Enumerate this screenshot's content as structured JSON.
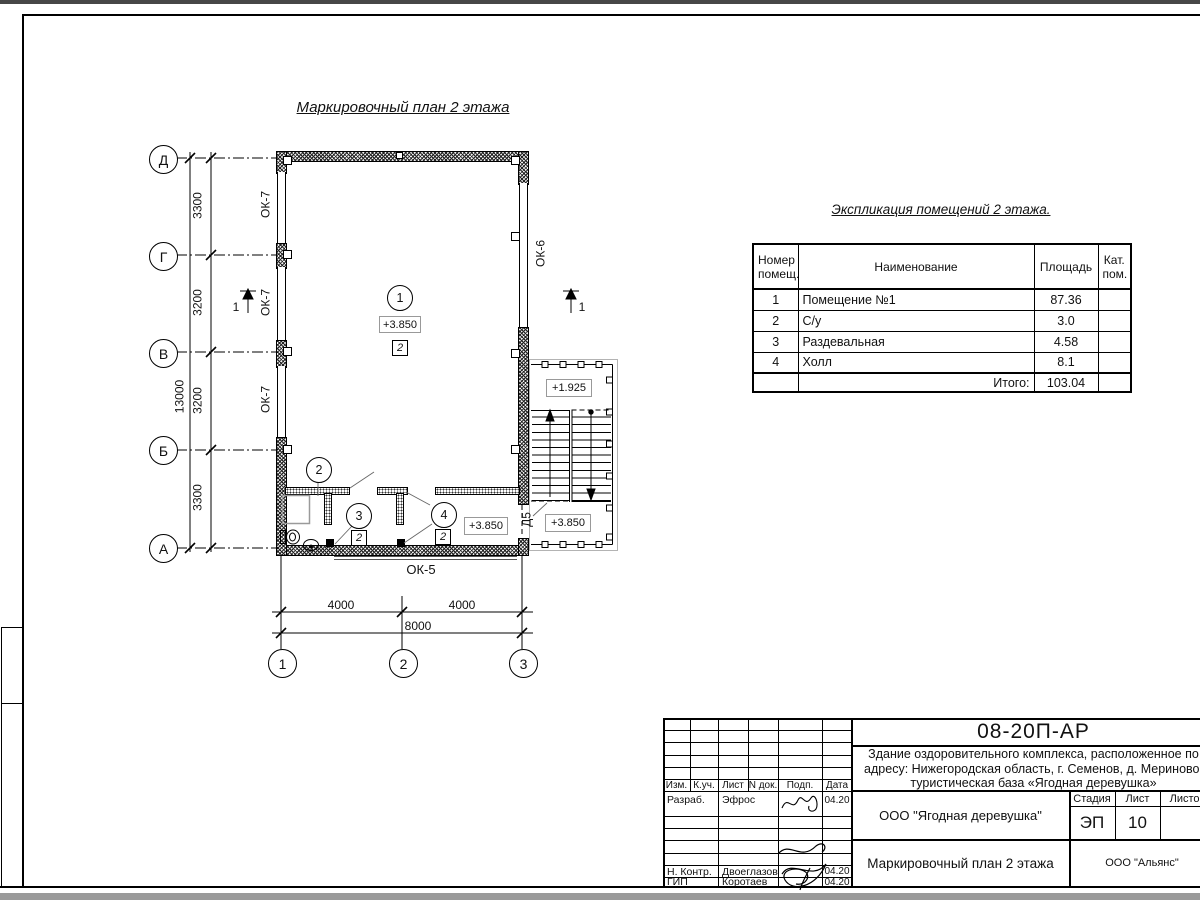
{
  "plan": {
    "title": "Маркировочный план 2 этажа",
    "axesH": [
      "Д",
      "Г",
      "В",
      "Б",
      "А"
    ],
    "axesV": [
      "1",
      "2",
      "3"
    ],
    "dimsLeft": [
      "3300",
      "3200",
      "3200",
      "3300"
    ],
    "dimLeftTotal": "13000",
    "dimsBottom": [
      "4000",
      "4000"
    ],
    "dimBottomTotal": "8000",
    "ok7": [
      "ОК-7",
      "ОК-7",
      "ОК-7"
    ],
    "ok6": "ОК-6",
    "ok5": "ОК-5",
    "d5": "Д5",
    "section": "1",
    "rooms": [
      "1",
      "2",
      "3",
      "4"
    ],
    "cat": "2",
    "elevMain": "+3.850",
    "elevHall": "+3.850",
    "elevStairMid": "+1.925",
    "elevStairBottom": "+3.850"
  },
  "table": {
    "title": "Экспликация помещений 2 этажа.",
    "colNum": "Номер помещ.",
    "colName": "Наименование",
    "colArea": "Площадь",
    "colCat": "Кат. пом.",
    "rows": [
      {
        "num": "1",
        "name": "Помещение №1",
        "area": "87.36",
        "cat": ""
      },
      {
        "num": "2",
        "name": "С/у",
        "area": "3.0",
        "cat": ""
      },
      {
        "num": "3",
        "name": "Раздевальная",
        "area": "4.58",
        "cat": ""
      },
      {
        "num": "4",
        "name": "Холл",
        "area": "8.1",
        "cat": ""
      }
    ],
    "totalLabel": "Итого:",
    "totalValue": "103.04"
  },
  "titleblock": {
    "code": "08-20П-АР",
    "objectLine1": "Здание оздоровительного комплекса, расположенное по",
    "objectLine2": "адресу: Нижегородская область, г. Семенов, д. Мериново,",
    "objectLine3": "туристическая база «Ягодная деревушка»",
    "cols": [
      "Изм.",
      "К.уч.",
      "Лист",
      "N док.",
      "Подп.",
      "Дата"
    ],
    "rowDevLabel": "Разраб.",
    "rowDevName": "Эфрос",
    "rowDevDate": "04.20",
    "rowNcLabel": "Н. Контр.",
    "rowNcName": "Двоеглазов",
    "rowNcDate": "04.20",
    "rowGipLabel": "ГИП",
    "rowGipName": "Коротаев",
    "rowGipDate": "04.20",
    "org": "ООО \"Ягодная деревушка\"",
    "stageLabel": "Стадия",
    "sheetLabel": "Лист",
    "sheetsLabel": "Листов",
    "stageValue": "ЭП",
    "sheetValue": "10",
    "docTitle": "Маркировочный план 2 этажа",
    "company": "ООО \"Альянс\""
  }
}
